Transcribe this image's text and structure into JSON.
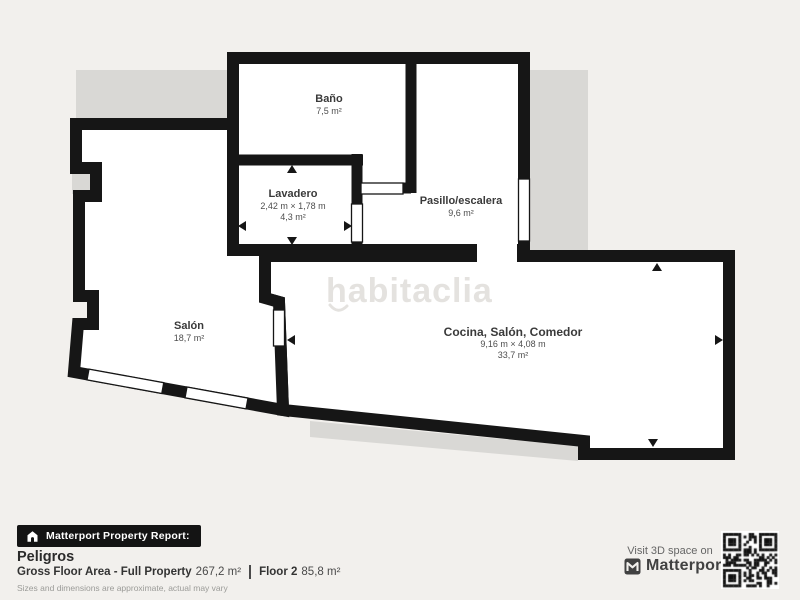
{
  "watermark": {
    "text": "habitaclia"
  },
  "rooms": {
    "bano": {
      "name": "Baño",
      "area": "7,5 m²"
    },
    "lavadero": {
      "name": "Lavadero",
      "dims": "2,42 m × 1,78 m",
      "area": "4,3 m²"
    },
    "pasillo": {
      "name": "Pasillo/escalera",
      "area": "9,6 m²"
    },
    "salon": {
      "name": "Salón",
      "area": "18,7 m²"
    },
    "cocina": {
      "name": "Cocina, Salón, Comedor",
      "dims": "9,16 m × 4,08 m",
      "area": "33,7 m²"
    }
  },
  "footer": {
    "report_badge": "Matterport Property Report:",
    "property_name": "Peligros",
    "gross_label": "Gross Floor Area - Full Property",
    "gross_value": "267,2 m²",
    "floor_label": "Floor 2",
    "floor_value": "85,8 m²",
    "disclaimer": "Sizes and dimensions are approximate, actual may vary",
    "visit_text": "Visit 3D space on",
    "brand": "Matterport"
  },
  "icons": {
    "badge_icon": "house-icon",
    "brand_icon": "matterport-m-icon",
    "qr": "qr-code"
  },
  "colors": {
    "background": "#f2f0ed",
    "wall": "#161616",
    "room_fill": "#ffffff",
    "silhouette": "#d9d8d5",
    "watermark": "#e4e2df",
    "badge_bg": "#141414"
  }
}
